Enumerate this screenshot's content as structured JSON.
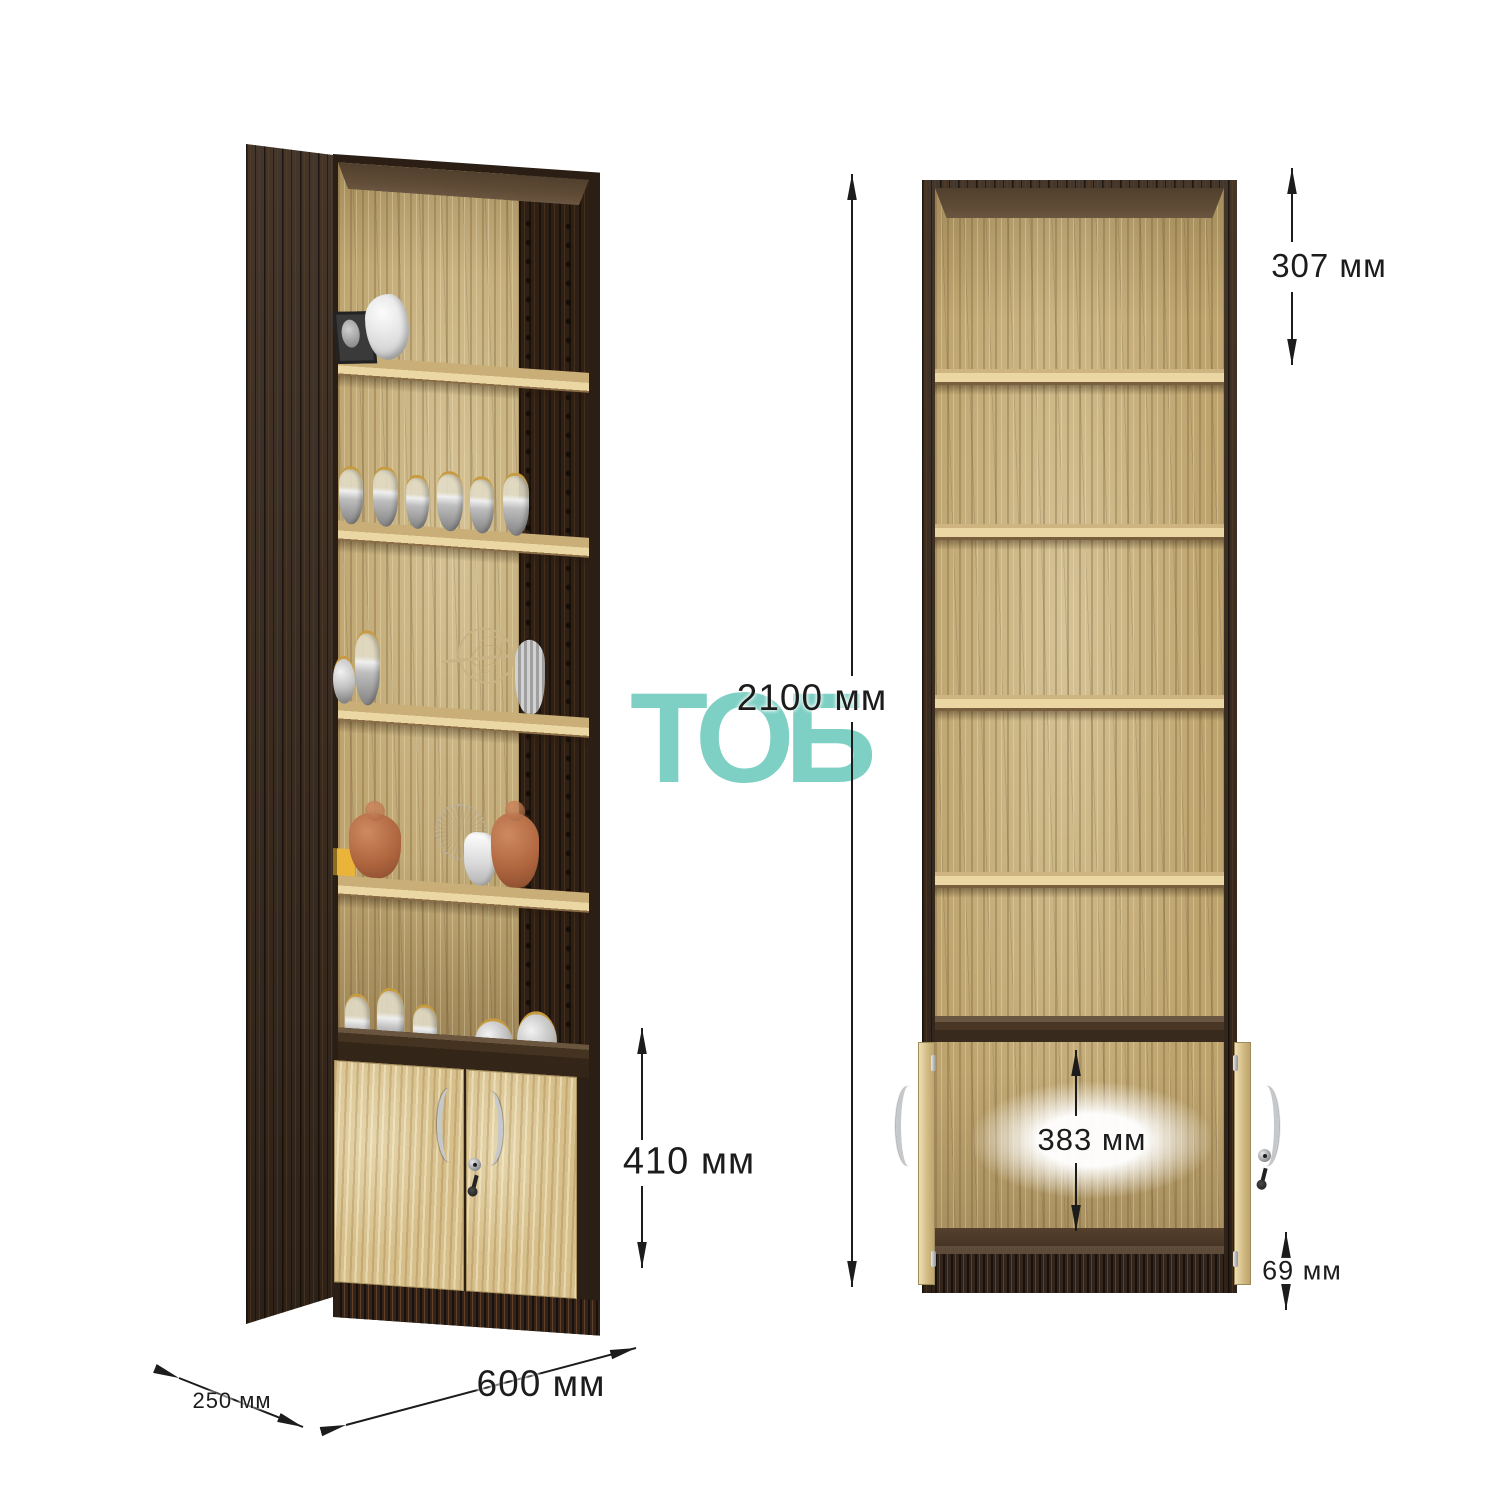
{
  "meta": {
    "type": "furniture-dimension-diagram",
    "product": "tall bookcase with lower two-door cabinet"
  },
  "logo": {
    "text": "ТОБ",
    "color": "#7ED0C4"
  },
  "dimension_labels": {
    "total_height": "2100 мм",
    "first_shelf": "307 мм",
    "doors_height": "410 мм",
    "cabinet_inner_height": "383 мм",
    "plinth_height": "69 мм",
    "width": "600 мм",
    "depth": "250 мм"
  },
  "units": {
    "left": {
      "view": "three-quarter perspective, decorated, doors closed",
      "decor_items": [
        "black photo frame",
        "white abstract sculpture",
        "six glass vases",
        "silver vases",
        "armillary sphere with arrow",
        "ribbed gray vase",
        "yellow box",
        "terracotta buddha figurine",
        "wire fan disc",
        "white amphora",
        "terracotta monkey figurine",
        "silver pots"
      ]
    },
    "right": {
      "view": "front, empty shelves, cabinet doors open with key in lock"
    }
  },
  "colors": {
    "accent_teal": "#7ED0C4",
    "dark_wood": "#34271C",
    "light_oak": "#C2AB7B",
    "shelf_edge": "#EAD7A3",
    "door_oak": "#D6BF8B",
    "dimension_text": "#1C1C1C"
  }
}
